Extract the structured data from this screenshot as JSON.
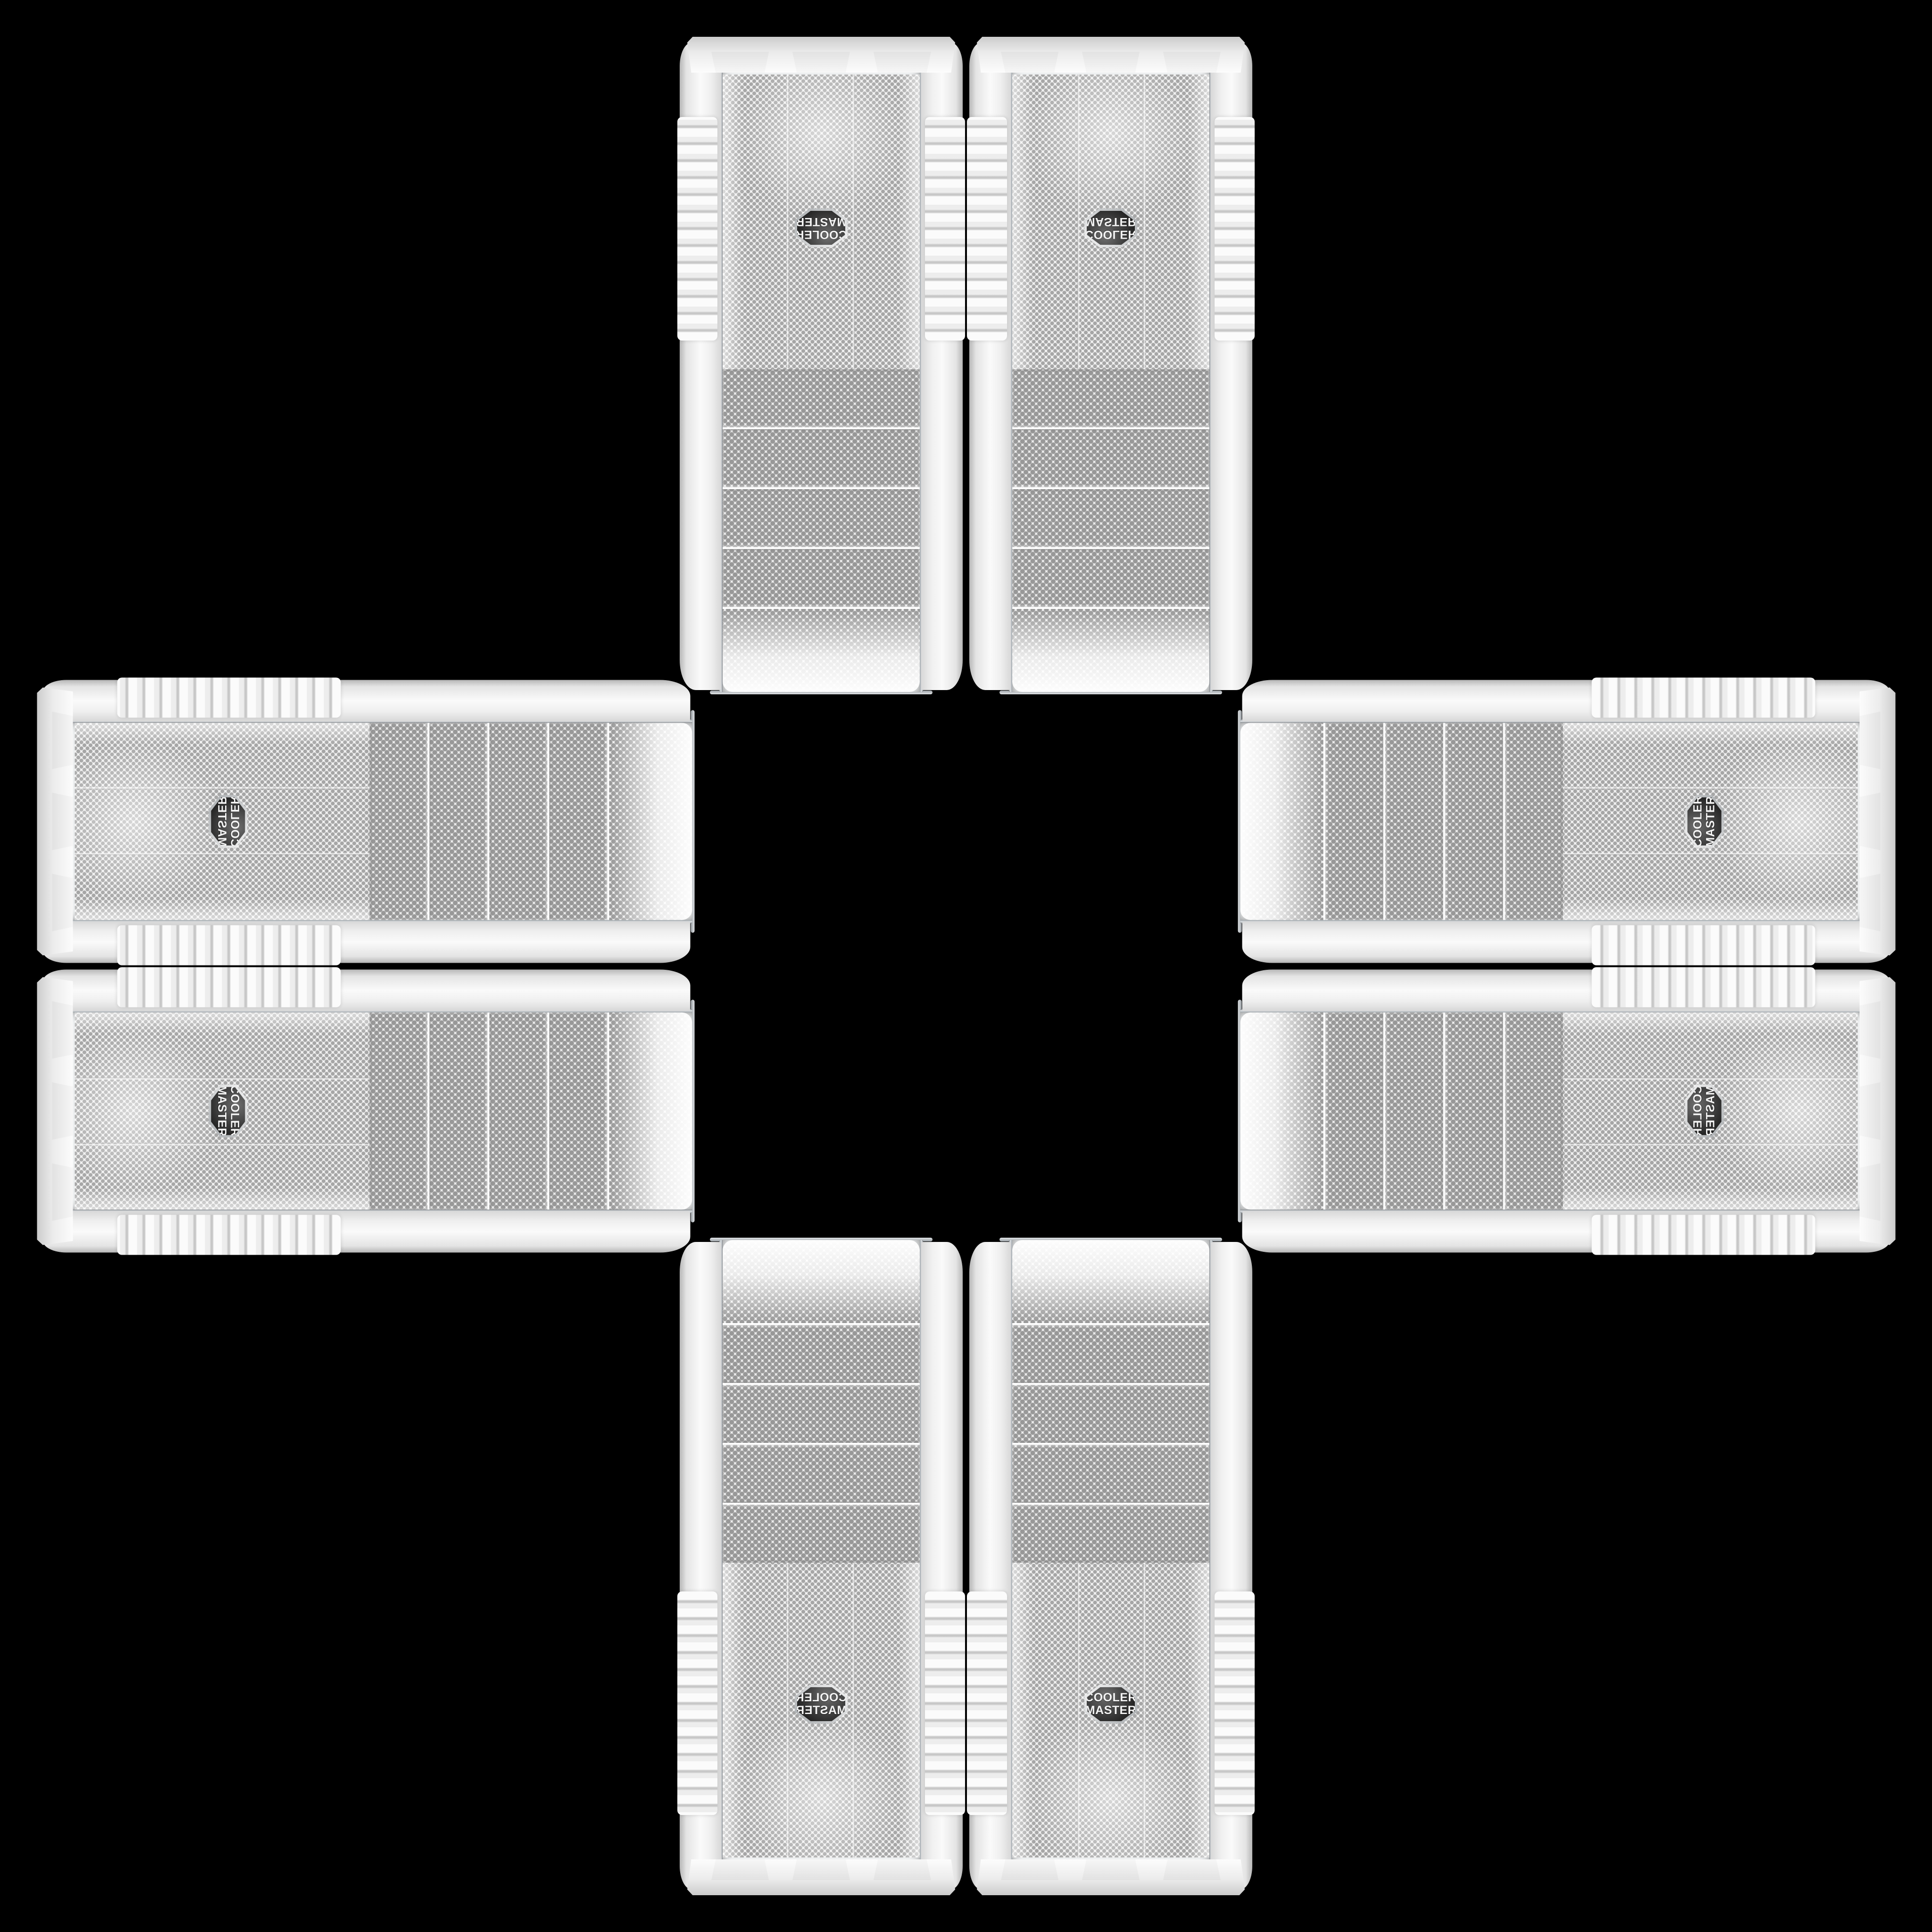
{
  "scene": {
    "description": "Eight identical white Cooler Master PC tower cases arranged in a mirrored cross pattern on a black background",
    "case_count": 8
  },
  "theme": {
    "page-bg": "#000000",
    "chrome": "#9aa0a5",
    "mesh-dot": "#989898",
    "mesh-dot-fine": "#a6a6a6",
    "badge-bg": "#262626",
    "badge-text": "#f4f4f4",
    "badge-ring": "#a8acaf"
  },
  "case": {
    "brand_line1": "COOLER",
    "brand_line2": "MASTER",
    "body_color": "#f0f0f0",
    "drive_bay_count": 4,
    "foot_tab_count": 3
  },
  "cases": [
    {
      "id": "top-left",
      "orientation": "rotated-180"
    },
    {
      "id": "top-right",
      "orientation": "flipped-vertical"
    },
    {
      "id": "left-top",
      "orientation": "rotated-90-flipped-vertical"
    },
    {
      "id": "left-bottom",
      "orientation": "rotated-90-clockwise"
    },
    {
      "id": "right-top",
      "orientation": "rotated-90-counterclockwise"
    },
    {
      "id": "right-bottom",
      "orientation": "rotated-90-flipped-horizontal"
    },
    {
      "id": "bottom-left",
      "orientation": "flipped-horizontal"
    },
    {
      "id": "bottom-right",
      "orientation": "upright"
    }
  ]
}
